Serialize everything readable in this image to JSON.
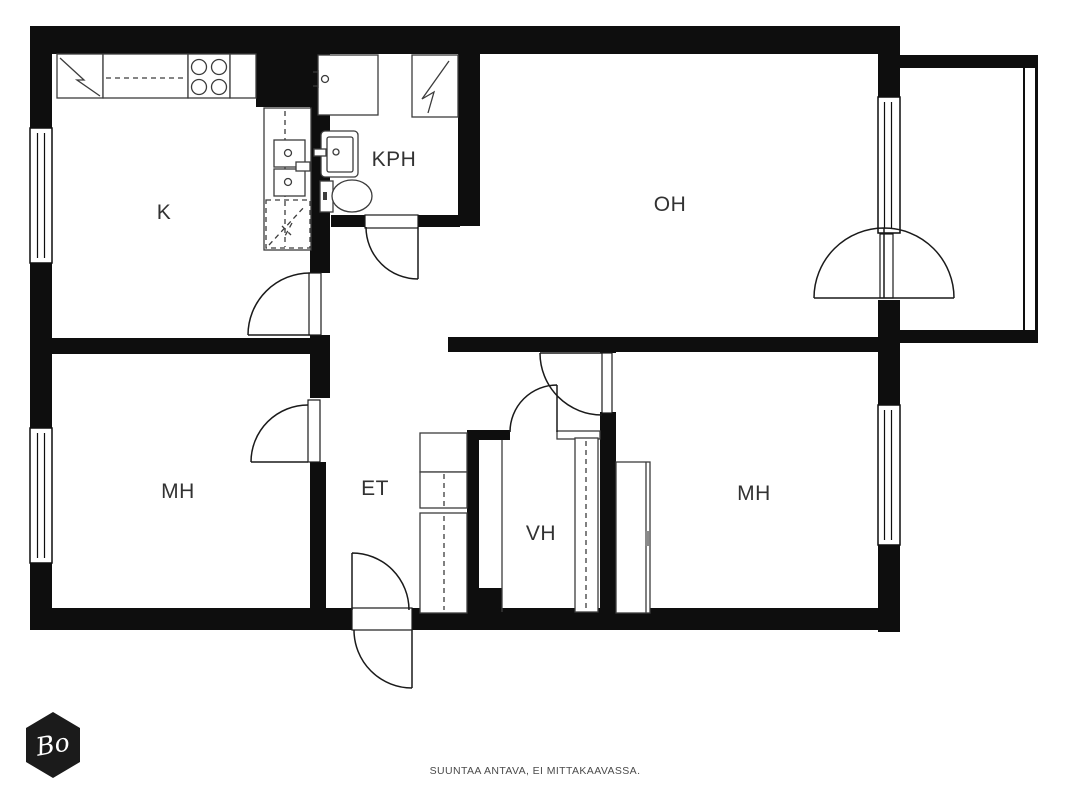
{
  "colors": {
    "wall": "#0e0e0e",
    "door": "#1a1a1a",
    "fixture": "#3c3c3c",
    "label": "#323232",
    "caption": "#4a4a4a",
    "logo_bg": "#1b1b1b",
    "logo_text": "#ffffff"
  },
  "rooms": [
    {
      "id": "kitchen",
      "label": "K"
    },
    {
      "id": "bathroom",
      "label": "KPH"
    },
    {
      "id": "living-room",
      "label": "OH"
    },
    {
      "id": "bedroom-left",
      "label": "MH"
    },
    {
      "id": "entry",
      "label": "ET"
    },
    {
      "id": "closet",
      "label": "VH"
    },
    {
      "id": "bedroom-right",
      "label": "MH"
    }
  ],
  "caption": {
    "text": "SUUNTAA ANTAVA, EI MITTAKAAVASSA."
  },
  "logo": {
    "text": "Bo"
  }
}
